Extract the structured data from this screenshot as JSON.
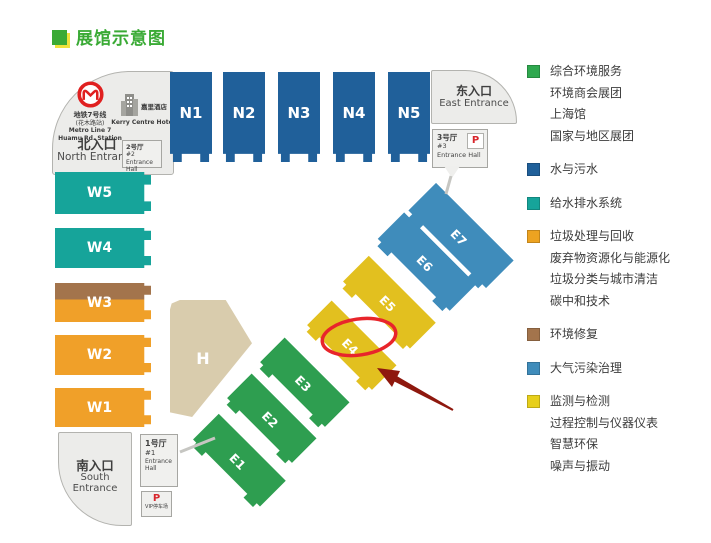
{
  "colors": {
    "title_green": "#3aaa35",
    "hall_blue": "#20609a",
    "hall_teal": "#16a49a",
    "hall_orange": "#f0a029",
    "hall_brown": "#a3744c",
    "hall_green": "#2e9e50",
    "hall_yellow": "#e2c01f",
    "hall_steelblue": "#3f8cbb",
    "hall_beige": "#d9ccad",
    "entrance_gray": "#ececea",
    "highlight_red": "#e8252b",
    "arrow_dark_red": "#8e180e",
    "parking_red": "#d8262c"
  },
  "title": "展馆示意图",
  "map": {
    "north_entrance": {
      "metro_line_cn": "地铁7号线",
      "metro_station_cn": "(花木路站)",
      "metro_line_en": "Metro Line 7",
      "metro_station_en": "Huamu Rd. Station",
      "hotel_cn": "嘉里酒店",
      "hotel_en": "Kerry Centre Hotel",
      "label_cn": "北入口",
      "label_en": "North Entrance"
    },
    "east_entrance": {
      "label_cn": "东入口",
      "label_en": "East Entrance"
    },
    "south_entrance": {
      "label_cn": "南入口",
      "label_en": "South Entrance"
    },
    "entrance_hall_1": {
      "name_cn": "1号厅",
      "number": "#1",
      "name_en": "Entrance Hall"
    },
    "entrance_hall_2": {
      "name_cn": "2号厅",
      "number": "#2",
      "name_en": "Entrance Hall"
    },
    "entrance_hall_3": {
      "name_cn": "3号厅",
      "number": "#3",
      "name_en": "Entrance Hall",
      "parking": "P"
    },
    "vip_parking": {
      "parking": "P",
      "label": "VIP停车场"
    },
    "halls_n": [
      "N1",
      "N2",
      "N3",
      "N4",
      "N5"
    ],
    "halls_w": [
      "W5",
      "W4",
      "W3",
      "W2",
      "W1"
    ],
    "halls_e": [
      "E1",
      "E2",
      "E3",
      "E4",
      "E5",
      "E6",
      "E7"
    ],
    "hall_h": "H",
    "highlighted_hall": "E4"
  },
  "legend": {
    "groups": [
      {
        "color": "#2fa84f",
        "lines": [
          "综合环境服务",
          "环境商会展团",
          "上海馆",
          "国家与地区展团"
        ]
      },
      {
        "color": "#20609a",
        "lines": [
          "水与污水"
        ]
      },
      {
        "color": "#16a49a",
        "lines": [
          "给水排水系统"
        ]
      },
      {
        "color": "#eda321",
        "lines": [
          "垃圾处理与回收",
          "废弃物资源化与能源化",
          "垃圾分类与城市清洁",
          "碳中和技术"
        ]
      },
      {
        "color": "#a3744c",
        "lines": [
          "环境修复"
        ]
      },
      {
        "color": "#3f8cbb",
        "lines": [
          "大气污染治理"
        ]
      },
      {
        "color": "#e7cf1b",
        "lines": [
          "监测与检测",
          "过程控制与仪器仪表",
          "智慧环保",
          "噪声与振动"
        ]
      }
    ]
  }
}
